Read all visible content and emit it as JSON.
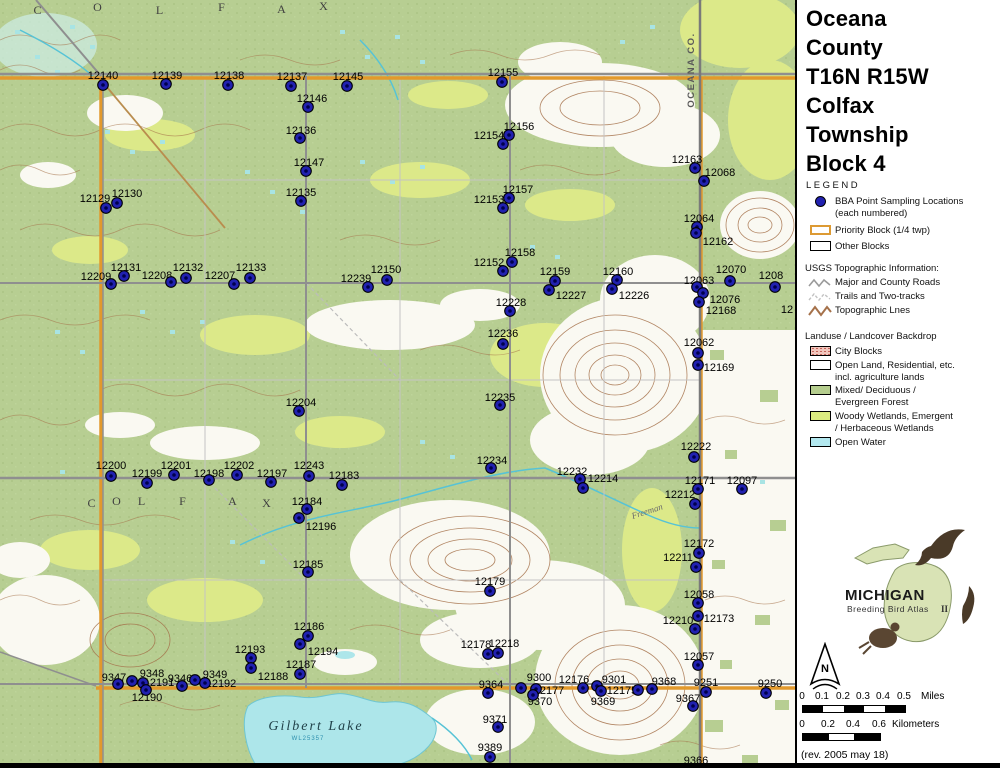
{
  "title": [
    "Oceana",
    "County",
    "T16N R15W",
    "Colfax",
    "Township",
    "Block 4"
  ],
  "legend": {
    "heading": "LEGEND",
    "points_line1": "BBA Point Sampling Locations",
    "points_line2": "(each numbered)",
    "priority_item": "Priority Block (1/4 twp)",
    "other_item": "Other Blocks",
    "usgs_heading": "USGS Topographic Information:",
    "roads_item": "Major and County Roads",
    "trails_item": "Trails and Two-tracks",
    "topo_item": "Topographic Lnes",
    "landuse_heading": "Landuse / Landcover Backdrop",
    "city_item": "City Blocks",
    "open_line1": "Open Land, Residential, etc.",
    "open_line2": "incl. agriculture lands",
    "mixed_line1": "Mixed/ Deciduous /",
    "mixed_line2": "Evergreen Forest",
    "woody_line1": "Woody Wetlands, Emergent",
    "woody_line2": "/ Herbaceous Wetlands",
    "water_item": "Open Water"
  },
  "logo": {
    "line1": "MICHIGAN",
    "line2": "Breeding Bird Atlas",
    "edition": "II"
  },
  "compass_label": "N",
  "scale": {
    "miles": {
      "t0": "0",
      "t1": "0.1",
      "t2": "0.2",
      "t3": "0.3",
      "t4": "0.4",
      "t5": "0.5",
      "unit": "Miles"
    },
    "km": {
      "t0": "0",
      "t1": "0.2",
      "t2": "0.4",
      "t3": "0.6",
      "unit": "Kilometers"
    }
  },
  "revision": "(rev. 2005 may 18)",
  "colors": {
    "forest": "#b7ce92",
    "wetland": "#dce989",
    "water": "#ade6ea",
    "contour": "#a5714a",
    "road": "#8f8f8f",
    "priority_block": "#e2992c",
    "point": "#2121b0"
  },
  "map": {
    "texts": [
      {
        "t": "OCEANA CO.",
        "x": 694,
        "y": 70,
        "r": -90,
        "cls": "county",
        "name": "county-line-label"
      },
      {
        "t": "C",
        "x": 38,
        "y": 14,
        "cls": "twp",
        "name": "township-letter"
      },
      {
        "t": "O",
        "x": 98,
        "y": 11,
        "cls": "twp",
        "name": "township-letter"
      },
      {
        "t": "L",
        "x": 160,
        "y": 14,
        "cls": "twp",
        "name": "township-letter"
      },
      {
        "t": "F",
        "x": 222,
        "y": 11,
        "cls": "twp",
        "name": "township-letter"
      },
      {
        "t": "A",
        "x": 282,
        "y": 13,
        "cls": "twp",
        "name": "township-letter"
      },
      {
        "t": "X",
        "x": 324,
        "y": 10,
        "cls": "twp",
        "name": "township-letter"
      },
      {
        "t": "C",
        "x": 92,
        "y": 507,
        "cls": "twp",
        "name": "township-letter"
      },
      {
        "t": "O",
        "x": 117,
        "y": 505,
        "cls": "twp",
        "name": "township-letter"
      },
      {
        "t": "L",
        "x": 142,
        "y": 505,
        "cls": "twp",
        "name": "township-letter"
      },
      {
        "t": "F",
        "x": 183,
        "y": 505,
        "cls": "twp",
        "name": "township-letter"
      },
      {
        "t": "A",
        "x": 233,
        "y": 505,
        "cls": "twp",
        "name": "township-letter"
      },
      {
        "t": "X",
        "x": 267,
        "y": 507,
        "cls": "twp",
        "name": "township-letter"
      },
      {
        "t": "Gilbert   Lake",
        "x": 316,
        "y": 730,
        "cls": "lake",
        "name": "lake-label"
      },
      {
        "t": "WL25357",
        "x": 308,
        "y": 740,
        "cls": "lakesub",
        "name": "lake-sublabel"
      },
      {
        "t": "Freeman",
        "x": 648,
        "y": 514,
        "r": -18,
        "cls": "stream",
        "name": "stream-label"
      },
      {
        "t": "12",
        "x": 787,
        "y": 313,
        "cls": "plabel",
        "name": "clipped-point-label"
      },
      {
        "t": "9366",
        "x": 696,
        "y": 764,
        "cls": "plabel",
        "name": "point-label-9366"
      }
    ],
    "points": [
      {
        "l": "12140",
        "x": 103,
        "y": 85,
        "lx": 103,
        "ly": 75
      },
      {
        "l": "12139",
        "x": 166,
        "y": 84,
        "lx": 167,
        "ly": 75
      },
      {
        "l": "12138",
        "x": 228,
        "y": 85,
        "lx": 229,
        "ly": 75
      },
      {
        "l": "12137",
        "x": 291,
        "y": 86,
        "lx": 292,
        "ly": 76
      },
      {
        "l": "12145",
        "x": 347,
        "y": 86,
        "lx": 348,
        "ly": 76
      },
      {
        "l": "12155",
        "x": 502,
        "y": 82,
        "lx": 503,
        "ly": 72
      },
      {
        "l": "12146",
        "x": 308,
        "y": 107,
        "lx": 312,
        "ly": 98
      },
      {
        "l": "12136",
        "x": 300,
        "y": 138,
        "lx": 301,
        "ly": 130
      },
      {
        "l": "12156",
        "x": 509,
        "y": 135,
        "lx": 519,
        "ly": 126
      },
      {
        "l": "12154",
        "x": 503,
        "y": 144,
        "lx": 489,
        "ly": 135
      },
      {
        "l": "12147",
        "x": 306,
        "y": 171,
        "lx": 309,
        "ly": 162
      },
      {
        "l": "12163",
        "x": 695,
        "y": 168,
        "lx": 687,
        "ly": 159
      },
      {
        "l": "12068",
        "x": 704,
        "y": 181,
        "lx": 720,
        "ly": 172
      },
      {
        "l": "12135",
        "x": 301,
        "y": 201,
        "lx": 301,
        "ly": 192
      },
      {
        "l": "12157",
        "x": 509,
        "y": 198,
        "lx": 518,
        "ly": 189
      },
      {
        "l": "12153",
        "x": 503,
        "y": 208,
        "lx": 489,
        "ly": 199
      },
      {
        "l": "12129",
        "x": 106,
        "y": 208,
        "lx": 95,
        "ly": 198
      },
      {
        "l": "12130",
        "x": 117,
        "y": 203,
        "lx": 127,
        "ly": 193
      },
      {
        "l": "12064",
        "x": 697,
        "y": 227,
        "lx": 699,
        "ly": 218
      },
      {
        "l": "12162",
        "x": 696,
        "y": 233,
        "lx": 718,
        "ly": 241
      },
      {
        "l": "12158",
        "x": 512,
        "y": 262,
        "lx": 520,
        "ly": 252
      },
      {
        "l": "12152",
        "x": 503,
        "y": 271,
        "lx": 489,
        "ly": 262
      },
      {
        "l": "12209",
        "x": 111,
        "y": 284,
        "lx": 96,
        "ly": 276
      },
      {
        "l": "12131",
        "x": 124,
        "y": 276,
        "lx": 126,
        "ly": 267
      },
      {
        "l": "12208",
        "x": 171,
        "y": 282,
        "lx": 157,
        "ly": 275
      },
      {
        "l": "12132",
        "x": 186,
        "y": 278,
        "lx": 188,
        "ly": 267
      },
      {
        "l": "12207",
        "x": 234,
        "y": 284,
        "lx": 220,
        "ly": 275
      },
      {
        "l": "12133",
        "x": 250,
        "y": 278,
        "lx": 251,
        "ly": 267
      },
      {
        "l": "12239",
        "x": 368,
        "y": 287,
        "lx": 356,
        "ly": 278
      },
      {
        "l": "12150",
        "x": 387,
        "y": 280,
        "lx": 386,
        "ly": 269
      },
      {
        "l": "12159",
        "x": 555,
        "y": 281,
        "lx": 555,
        "ly": 271
      },
      {
        "l": "12227",
        "x": 549,
        "y": 290,
        "lx": 571,
        "ly": 295
      },
      {
        "l": "12160",
        "x": 617,
        "y": 280,
        "lx": 618,
        "ly": 271
      },
      {
        "l": "12226",
        "x": 612,
        "y": 289,
        "lx": 634,
        "ly": 295
      },
      {
        "l": "12063",
        "x": 697,
        "y": 287,
        "lx": 699,
        "ly": 280
      },
      {
        "l": "12070",
        "x": 730,
        "y": 281,
        "lx": 731,
        "ly": 269
      },
      {
        "l": "1208",
        "x": 775,
        "y": 287,
        "lx": 771,
        "ly": 275
      },
      {
        "l": "12076",
        "x": 703,
        "y": 293,
        "lx": 725,
        "ly": 299
      },
      {
        "l": "12168",
        "x": 699,
        "y": 302,
        "lx": 721,
        "ly": 310
      },
      {
        "l": "12228",
        "x": 510,
        "y": 311,
        "lx": 511,
        "ly": 302
      },
      {
        "l": "12236",
        "x": 503,
        "y": 344,
        "lx": 503,
        "ly": 333
      },
      {
        "l": "12062",
        "x": 698,
        "y": 353,
        "lx": 699,
        "ly": 342
      },
      {
        "l": "12169",
        "x": 698,
        "y": 365,
        "lx": 719,
        "ly": 367
      },
      {
        "l": "12204",
        "x": 299,
        "y": 411,
        "lx": 301,
        "ly": 402
      },
      {
        "l": "12235",
        "x": 500,
        "y": 405,
        "lx": 500,
        "ly": 397
      },
      {
        "l": "12222",
        "x": 694,
        "y": 457,
        "lx": 696,
        "ly": 446
      },
      {
        "l": "12200",
        "x": 111,
        "y": 476,
        "lx": 111,
        "ly": 465
      },
      {
        "l": "12199",
        "x": 147,
        "y": 483,
        "lx": 147,
        "ly": 473
      },
      {
        "l": "12201",
        "x": 174,
        "y": 475,
        "lx": 176,
        "ly": 465
      },
      {
        "l": "12198",
        "x": 209,
        "y": 480,
        "lx": 209,
        "ly": 473
      },
      {
        "l": "12202",
        "x": 237,
        "y": 475,
        "lx": 239,
        "ly": 465
      },
      {
        "l": "12197",
        "x": 271,
        "y": 482,
        "lx": 272,
        "ly": 473
      },
      {
        "l": "12243",
        "x": 309,
        "y": 476,
        "lx": 309,
        "ly": 465
      },
      {
        "l": "12183",
        "x": 342,
        "y": 485,
        "lx": 344,
        "ly": 475
      },
      {
        "l": "12234",
        "x": 491,
        "y": 468,
        "lx": 492,
        "ly": 460
      },
      {
        "l": "12232",
        "x": 580,
        "y": 479,
        "lx": 572,
        "ly": 471
      },
      {
        "l": "12214",
        "x": 583,
        "y": 488,
        "lx": 603,
        "ly": 478
      },
      {
        "l": "12171",
        "x": 698,
        "y": 489,
        "lx": 700,
        "ly": 480
      },
      {
        "l": "12097",
        "x": 742,
        "y": 489,
        "lx": 742,
        "ly": 480
      },
      {
        "l": "12212",
        "x": 695,
        "y": 504,
        "lx": 680,
        "ly": 494
      },
      {
        "l": "12184",
        "x": 307,
        "y": 509,
        "lx": 307,
        "ly": 501
      },
      {
        "l": "12196",
        "x": 299,
        "y": 518,
        "lx": 321,
        "ly": 526
      },
      {
        "l": "12185",
        "x": 308,
        "y": 572,
        "lx": 308,
        "ly": 564
      },
      {
        "l": "12179",
        "x": 490,
        "y": 591,
        "lx": 490,
        "ly": 581
      },
      {
        "l": "12172",
        "x": 699,
        "y": 553,
        "lx": 699,
        "ly": 543
      },
      {
        "l": "12211",
        "x": 696,
        "y": 567,
        "lx": 678,
        "ly": 557
      },
      {
        "l": "12058",
        "x": 698,
        "y": 603,
        "lx": 699,
        "ly": 594
      },
      {
        "l": "12173",
        "x": 698,
        "y": 616,
        "lx": 719,
        "ly": 618
      },
      {
        "l": "12210",
        "x": 695,
        "y": 629,
        "lx": 678,
        "ly": 620
      },
      {
        "l": "12057",
        "x": 698,
        "y": 665,
        "lx": 699,
        "ly": 656
      },
      {
        "l": "12186",
        "x": 308,
        "y": 636,
        "lx": 309,
        "ly": 626
      },
      {
        "l": "12194",
        "x": 300,
        "y": 644,
        "lx": 323,
        "ly": 651
      },
      {
        "l": "12193",
        "x": 251,
        "y": 658,
        "lx": 250,
        "ly": 649
      },
      {
        "l": "12188",
        "x": 251,
        "y": 668,
        "lx": 273,
        "ly": 676
      },
      {
        "l": "12187",
        "x": 300,
        "y": 674,
        "lx": 301,
        "ly": 664
      },
      {
        "l": "9347",
        "x": 118,
        "y": 684,
        "lx": 114,
        "ly": 677
      },
      {
        "l": "9348",
        "x": 132,
        "y": 681,
        "lx": 152,
        "ly": 673
      },
      {
        "l": "12191",
        "x": 143,
        "y": 683,
        "lx": 159,
        "ly": 682
      },
      {
        "l": "9346",
        "x": 182,
        "y": 686,
        "lx": 180,
        "ly": 678
      },
      {
        "l": "9349",
        "x": 195,
        "y": 680,
        "lx": 215,
        "ly": 674
      },
      {
        "l": "12192",
        "x": 205,
        "y": 683,
        "lx": 221,
        "ly": 683
      },
      {
        "l": "12190",
        "x": 146,
        "y": 690,
        "lx": 147,
        "ly": 697
      },
      {
        "l": "12178",
        "x": 488,
        "y": 654,
        "lx": 476,
        "ly": 644
      },
      {
        "l": "12218",
        "x": 498,
        "y": 653,
        "lx": 504,
        "ly": 643
      },
      {
        "l": "9364",
        "x": 488,
        "y": 693,
        "lx": 491,
        "ly": 684
      },
      {
        "l": "9300",
        "x": 521,
        "y": 688,
        "lx": 539,
        "ly": 677
      },
      {
        "l": "12177",
        "x": 536,
        "y": 689,
        "lx": 549,
        "ly": 690
      },
      {
        "l": "9370",
        "x": 533,
        "y": 695,
        "lx": 540,
        "ly": 701
      },
      {
        "l": "12176",
        "x": 583,
        "y": 688,
        "lx": 574,
        "ly": 679
      },
      {
        "l": "9301",
        "x": 597,
        "y": 686,
        "lx": 614,
        "ly": 679
      },
      {
        "l": "9369",
        "x": 601,
        "y": 691,
        "lx": 603,
        "ly": 701
      },
      {
        "l": "12175",
        "x": 638,
        "y": 690,
        "lx": 622,
        "ly": 690
      },
      {
        "l": "9368",
        "x": 652,
        "y": 689,
        "lx": 664,
        "ly": 681
      },
      {
        "l": "9251",
        "x": 706,
        "y": 692,
        "lx": 706,
        "ly": 682
      },
      {
        "l": "9367",
        "x": 693,
        "y": 706,
        "lx": 688,
        "ly": 698
      },
      {
        "l": "9250",
        "x": 766,
        "y": 693,
        "lx": 770,
        "ly": 683
      },
      {
        "l": "9371",
        "x": 498,
        "y": 727,
        "lx": 495,
        "ly": 719
      },
      {
        "l": "9389",
        "x": 490,
        "y": 757,
        "lx": 490,
        "ly": 747
      }
    ]
  }
}
